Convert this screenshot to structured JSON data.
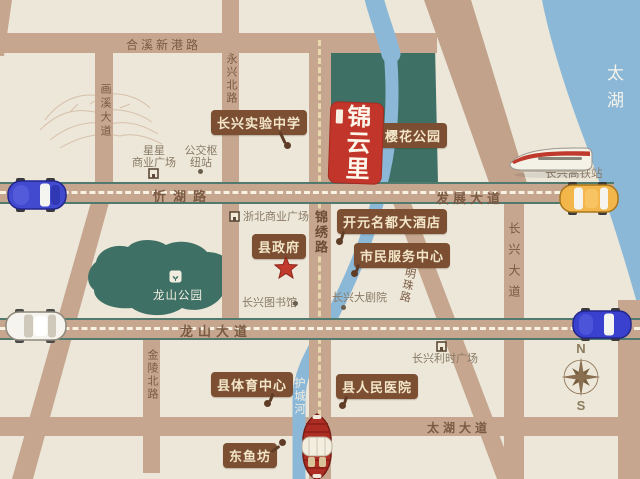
{
  "logo": {
    "name": "锦云里"
  },
  "lake": {
    "label": "太湖"
  },
  "river": {
    "label": "护城河"
  },
  "park": {
    "longshan": "龙山公园"
  },
  "roads": {
    "hexin_xingang": "合溪新港路",
    "huaxi_avenue": "画溪大道",
    "yongxing_north": "永兴北路",
    "xinhu": "忻湖路",
    "fazhan_avenue": "发展大道",
    "jinxiu": "锦绣路",
    "longshan_avenue": "龙山大道",
    "jinling_north": "金陵北路",
    "mingzhu": "明珠路",
    "changxing_avenue": "长兴大道",
    "taihu_avenue": "太湖大道"
  },
  "callouts": {
    "experimental_school": "长兴实验中学",
    "sakura_park": "樱花公园",
    "kaiyuan_hotel": "开元名都大酒店",
    "citizen_service_center": "市民服务中心",
    "county_government": "县政府",
    "county_sports_center": "县体育中心",
    "county_people_hospital": "县人民医院",
    "dongyufang": "东鱼坊"
  },
  "pois": {
    "xingxing_plaza_line1": "星星",
    "xingxing_plaza_line2": "商业广场",
    "bus_hub_line1": "公交枢",
    "bus_hub_line2": "纽站",
    "zhebei_plaza": "浙北商业广场",
    "library": "长兴图书馆",
    "grand_theater": "长兴大剧院",
    "lishi_plaza": "长兴利时广场",
    "hsr_station": "长兴高铁站"
  },
  "compass": {
    "north": "N",
    "south": "S"
  },
  "colors": {
    "background": "#ece7d9",
    "road": "#c6a68f",
    "road_edge": "#4f7a6d",
    "water": "#8cb8d8",
    "park_green": "#3f7065",
    "label_brown": "#7c4f33",
    "label_text": "#f3e6c9",
    "logo_red": "#c2352a",
    "star_red": "#c23a2b"
  }
}
